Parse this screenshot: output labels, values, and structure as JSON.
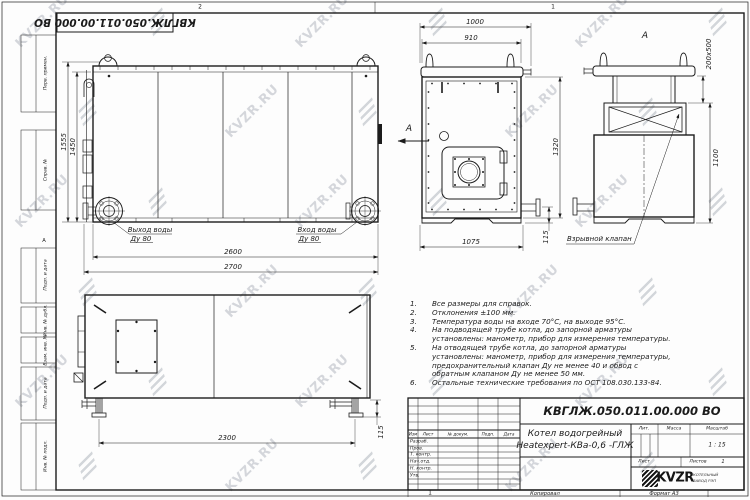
{
  "sheet": {
    "stamp_rotated": "КВГЛЖ.050.011.00.000 ВО",
    "zones": {
      "top_left": "2",
      "top_right": "1",
      "bottom": "1",
      "row_letter": "А"
    },
    "margin_labels": {
      "perv_primen": "Перв. примен.",
      "sprav_no": "Справ. №",
      "podp_data_1": "Подп. и дата",
      "inv_dubl": "Инв. № дубл.",
      "vzam_inv": "Взам. инв. №",
      "podp_data_2": "Подп. и дата",
      "inv_podl": "Инв. № подл."
    },
    "footer": {
      "copy": "Копировал",
      "format": "Формат А3"
    }
  },
  "watermark": {
    "text": "KVZR.RU"
  },
  "front_view": {
    "arrow_label": "А",
    "dims": {
      "h_total": "1555",
      "h_body": "1450",
      "w_body": "2600",
      "w_total": "2700"
    },
    "outlet": {
      "line1": "Выход воды",
      "line2": "Ду 80"
    },
    "inlet": {
      "line1": "Вход воды",
      "line2": "Ду 80"
    }
  },
  "side_view": {
    "dims": {
      "w_total": "1000",
      "w_body": "910",
      "h_body": "1320",
      "pipe": "115",
      "w_bottom": "1075"
    }
  },
  "view_a": {
    "label": "А",
    "dims": {
      "flue": "200x500",
      "h_valve": "1100"
    },
    "callout": "Взрывной клапан"
  },
  "bottom_view": {
    "dims": {
      "legs_span": "2300",
      "pipe": "115"
    }
  },
  "notes": {
    "items": [
      {
        "num": "1.",
        "text": "Все размеры для справок."
      },
      {
        "num": "2.",
        "text": "Отклонения ±100 мм."
      },
      {
        "num": "3.",
        "text": "Температура воды на входе 70°С, на выходе 95°С."
      },
      {
        "num": "4.",
        "text": "На подводящей трубе котла, до запорной арматуры установлены: манометр, прибор для измерения температуры."
      },
      {
        "num": "5.",
        "text": "На отводящей трубе котла, до запорной арматуры установлены: манометр, прибор для измерения температуры, предохранительный клапан Ду не менее 40 и обвод с обратным клапаном Ду не менее 50 мм."
      },
      {
        "num": "6.",
        "text": "Остальные технические требования по ОСТ 108.030.133-84."
      }
    ]
  },
  "title_block": {
    "doc_number": "КВГЛЖ.050.011.00.000 ВО",
    "name_line1": "Котел водогрейный",
    "name_line2": "Heatexpert-КВа-0,6 -ГЛЖ",
    "cols": {
      "izm": "Изм",
      "list": "Лист",
      "doc": "№ докум.",
      "podp": "Подп.",
      "data": "Дата"
    },
    "rows": {
      "razrab": "Разраб.",
      "prov": "Пров.",
      "tkontr": "Т. контр.",
      "nachotd": "Нач.отд.",
      "nkontr": "Н. контр.",
      "utv": "Утв."
    },
    "lit_label": "Лит.",
    "mass_label": "Масса",
    "scale_label": "Масштаб",
    "scale_value": "1 : 15",
    "sheet_label": "Лист",
    "sheets_label": "Листов",
    "sheets_value": "1",
    "logo_text": "KVZR",
    "company_line1": "КОТЕЛЬНЫЙ",
    "company_line2": "ЗАВОД РЭП"
  }
}
